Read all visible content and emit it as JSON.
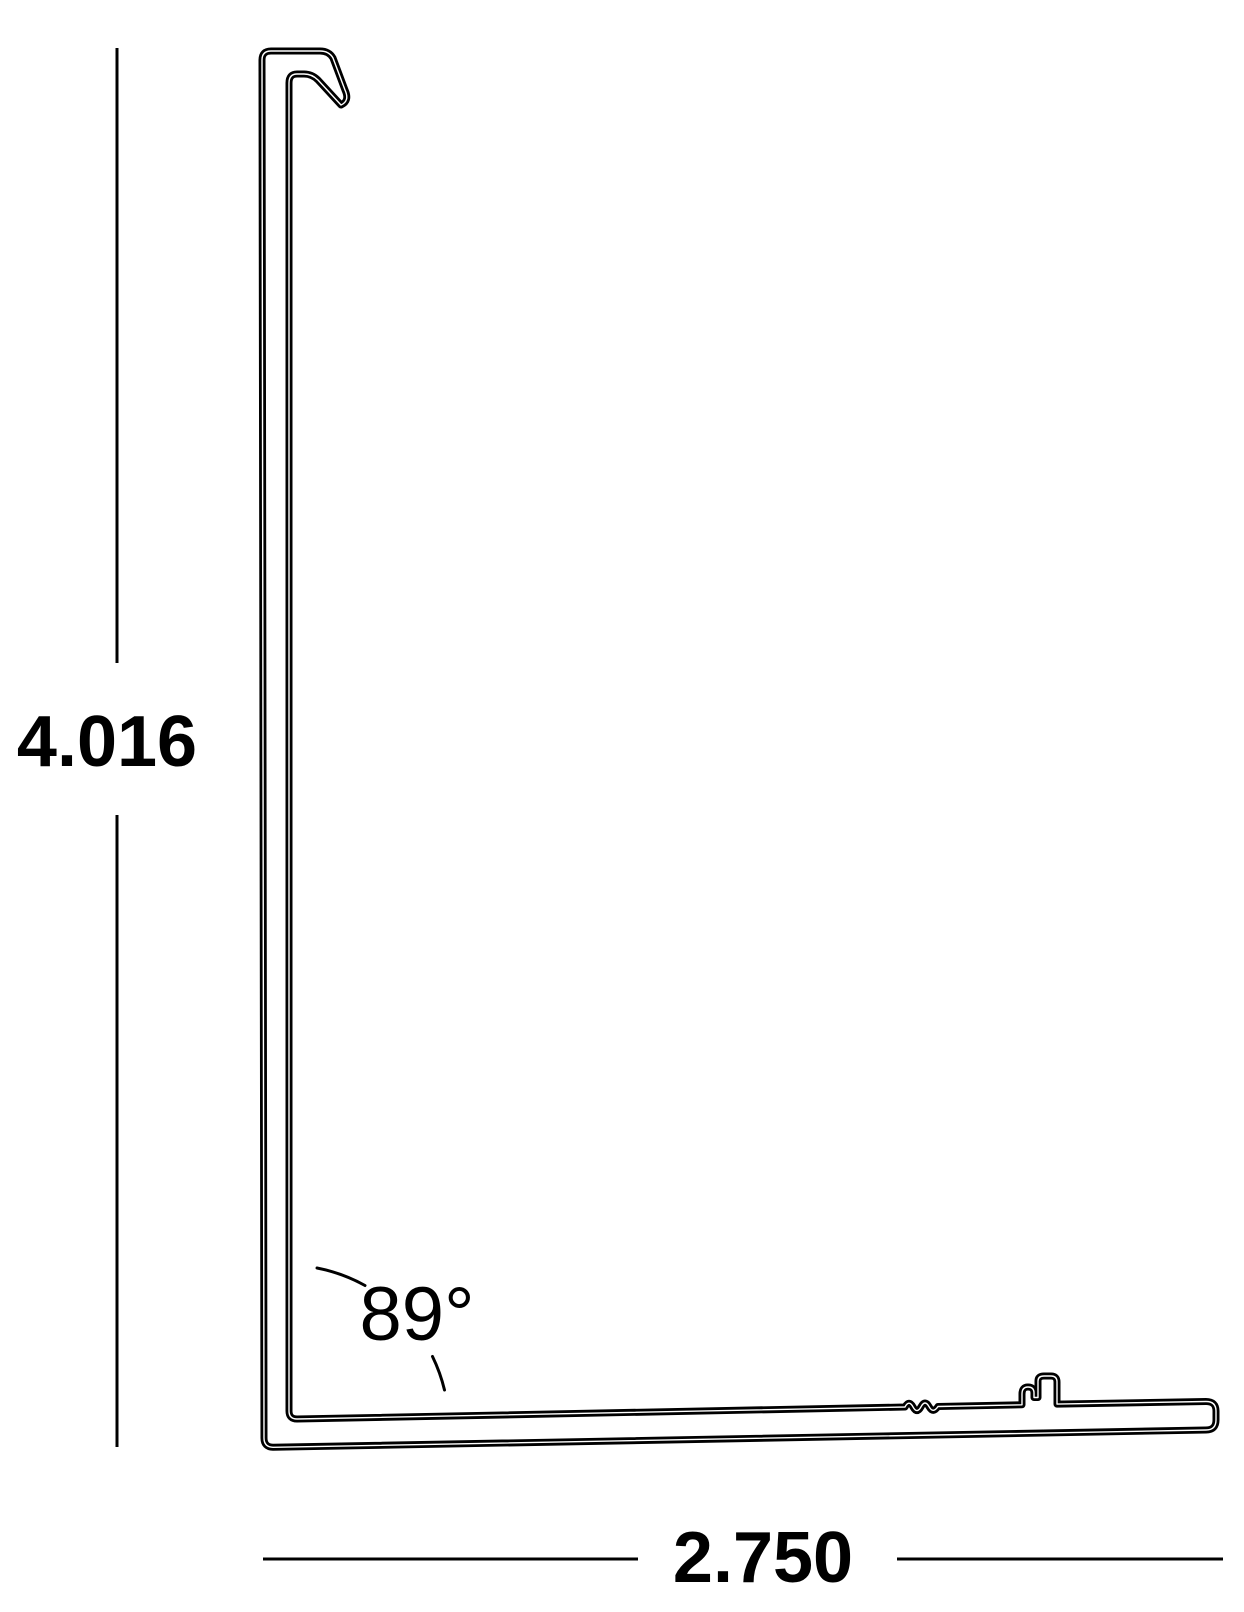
{
  "drawing": {
    "description": "L-shaped extrusion profile cross-section technical drawing",
    "height_dimension": {
      "label": "4.016"
    },
    "width_dimension": {
      "label": "2.750"
    },
    "angle_dimension": {
      "label": "89°"
    }
  },
  "colors": {
    "line": "#000000",
    "background": "#ffffff"
  }
}
